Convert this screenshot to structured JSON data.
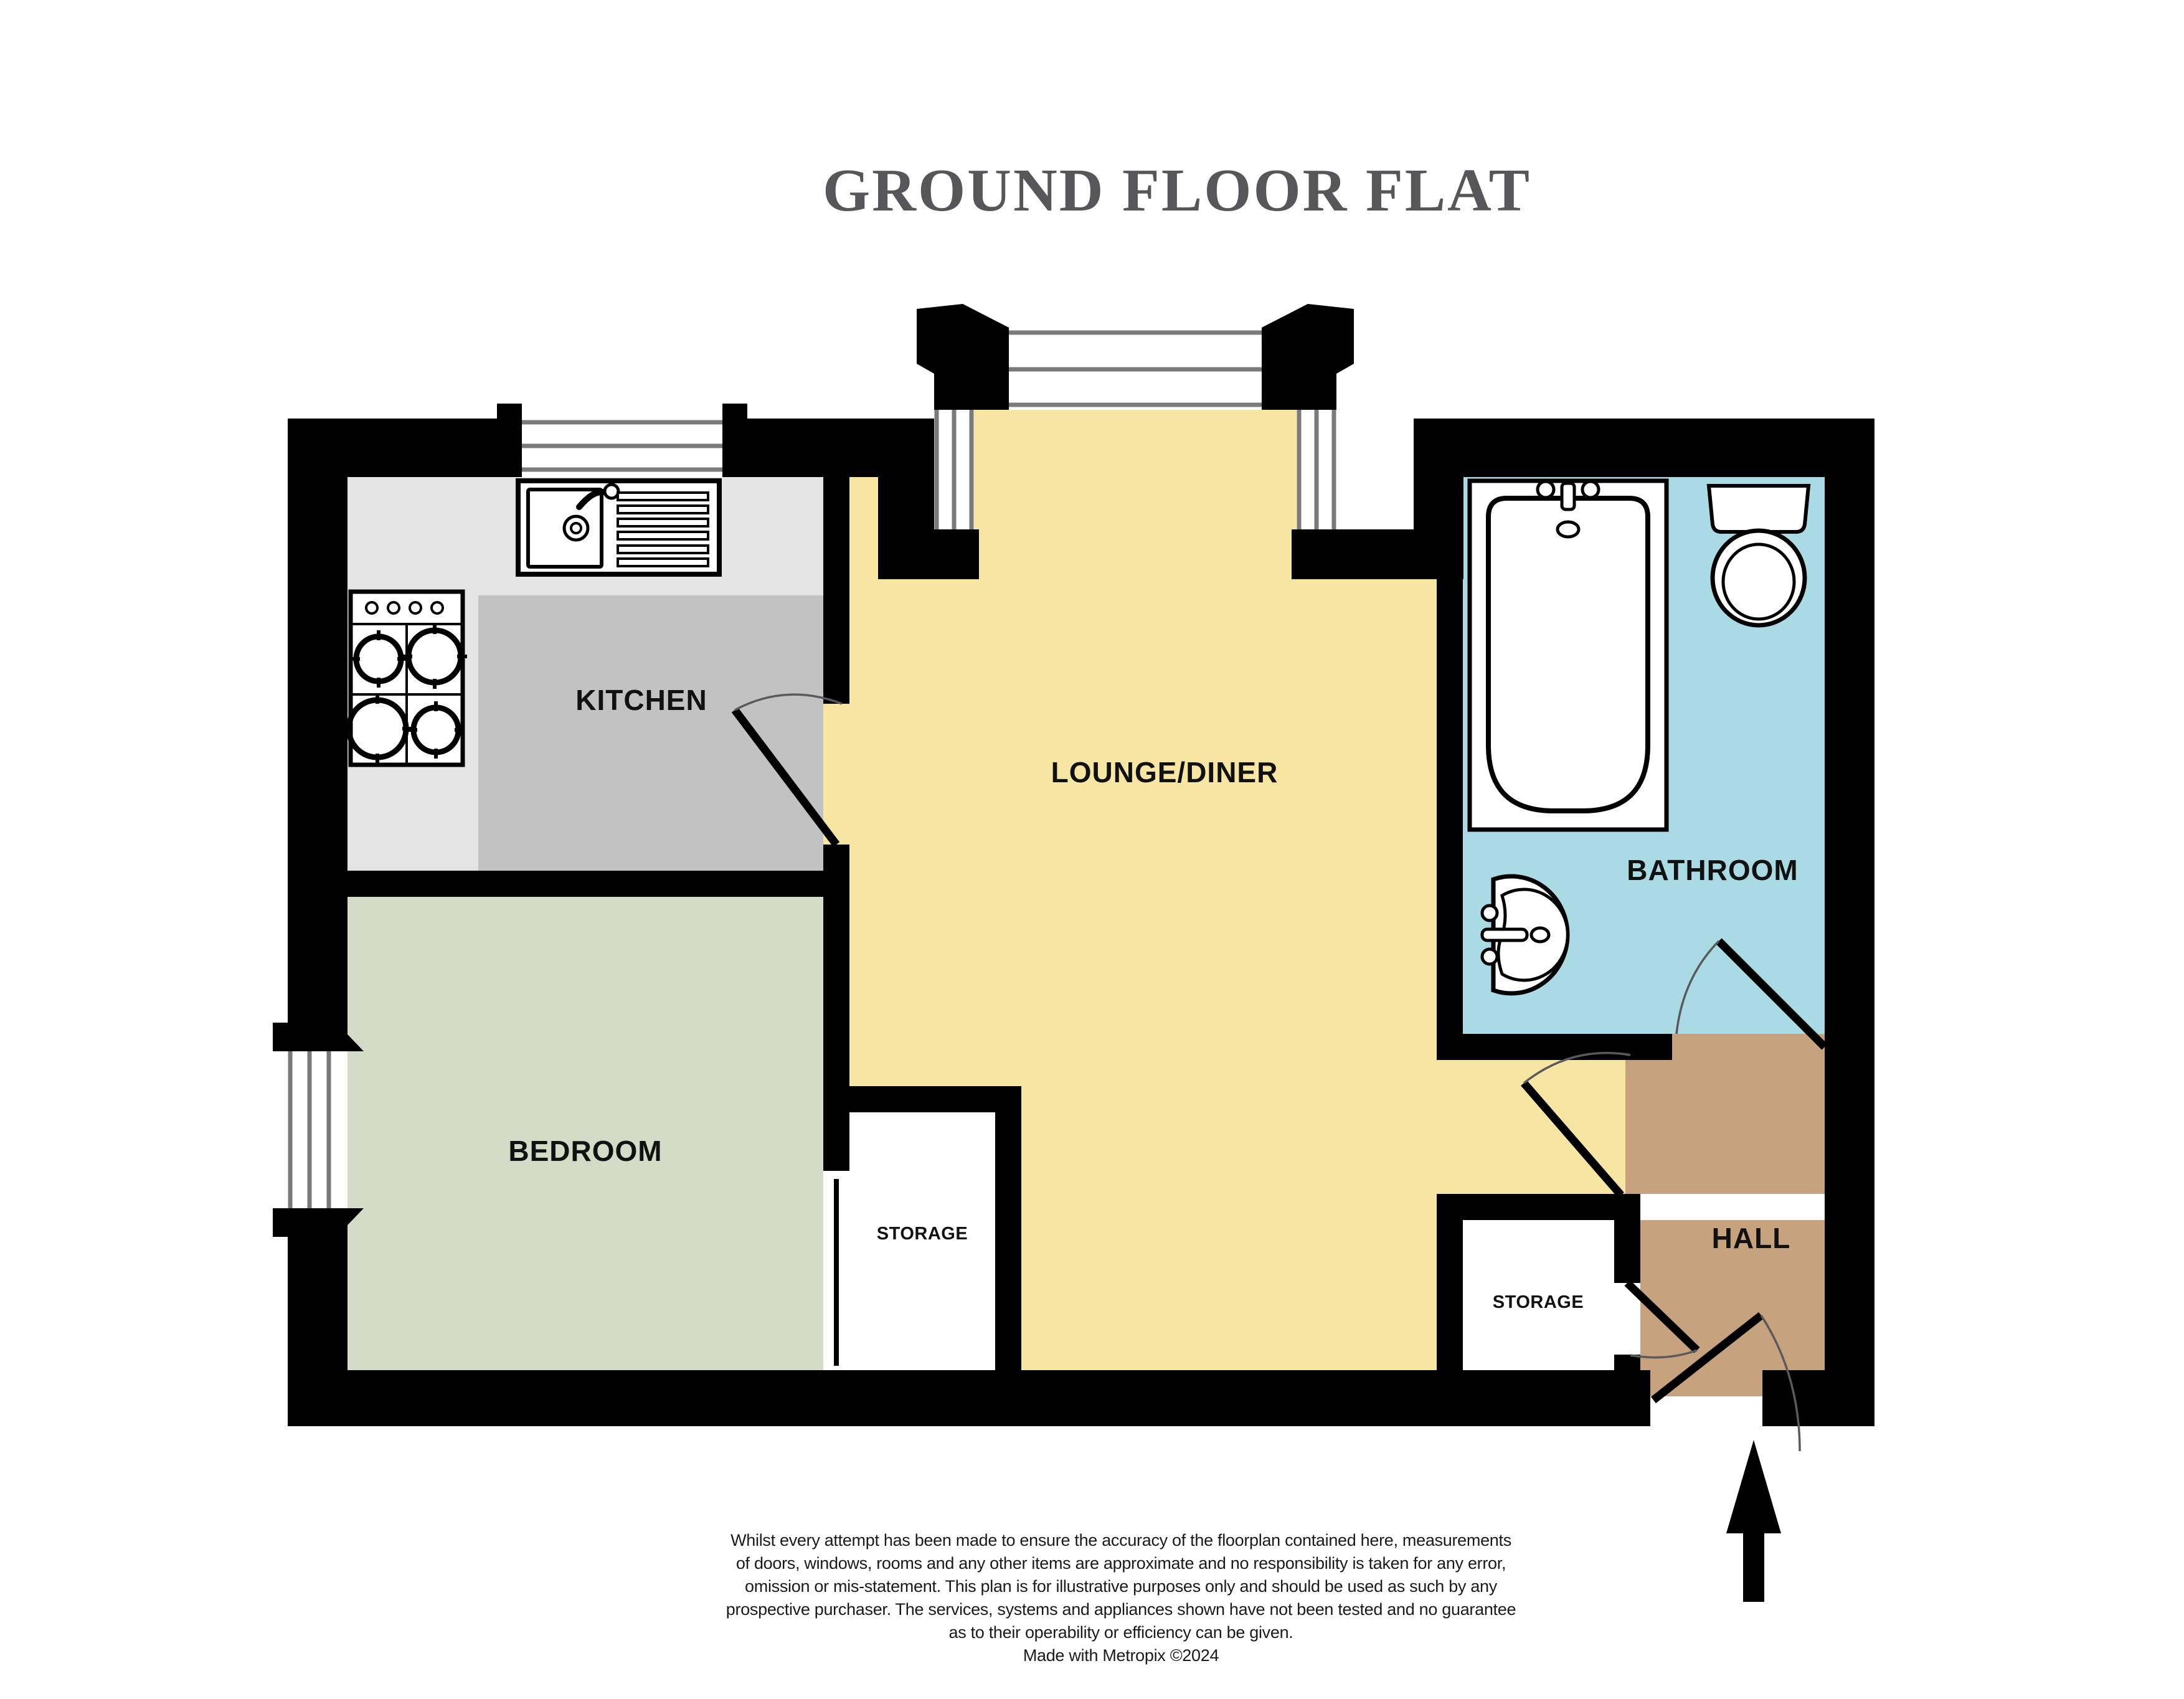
{
  "title": "GROUND FLOOR FLAT",
  "rooms": {
    "kitchen": {
      "label": "KITCHEN"
    },
    "lounge": {
      "label": "LOUNGE/DINER"
    },
    "bathroom": {
      "label": "BATHROOM"
    },
    "bedroom": {
      "label": "BEDROOM"
    },
    "hall": {
      "label": "HALL"
    },
    "storage_left": {
      "label": "STORAGE"
    },
    "storage_hall": {
      "label": "STORAGE"
    }
  },
  "fixtures": [
    "kitchen-sink",
    "hob",
    "bath",
    "toilet",
    "basin",
    "entrance-arrow"
  ],
  "disclaimer": {
    "lines": [
      "Whilst every attempt has been made to ensure the accuracy of the floorplan contained here, measurements",
      "of doors, windows, rooms and any other items are approximate and no responsibility is taken for any error,",
      "omission or mis-statement. This plan is for illustrative purposes only and should be used as such by any",
      "prospective purchaser. The services, systems and appliances shown have not been tested and no guarantee",
      "as to their operability or efficiency can be given."
    ],
    "credit": "Made with Metropix ©2024"
  },
  "colors": {
    "wall": "#000000",
    "kitchen_floor": "#e4e4e4",
    "kitchen_counter": "#c2c2c2",
    "lounge_floor": "#f6e5a3",
    "bathroom_floor": "#aadae3",
    "bedroom_floor": "#d4dbc6",
    "hall_floor": "#c6a27f",
    "storage_floor": "#ffffff",
    "window_line": "#7a7a7a",
    "title_color": "#57575a",
    "label_color": "#111111"
  }
}
